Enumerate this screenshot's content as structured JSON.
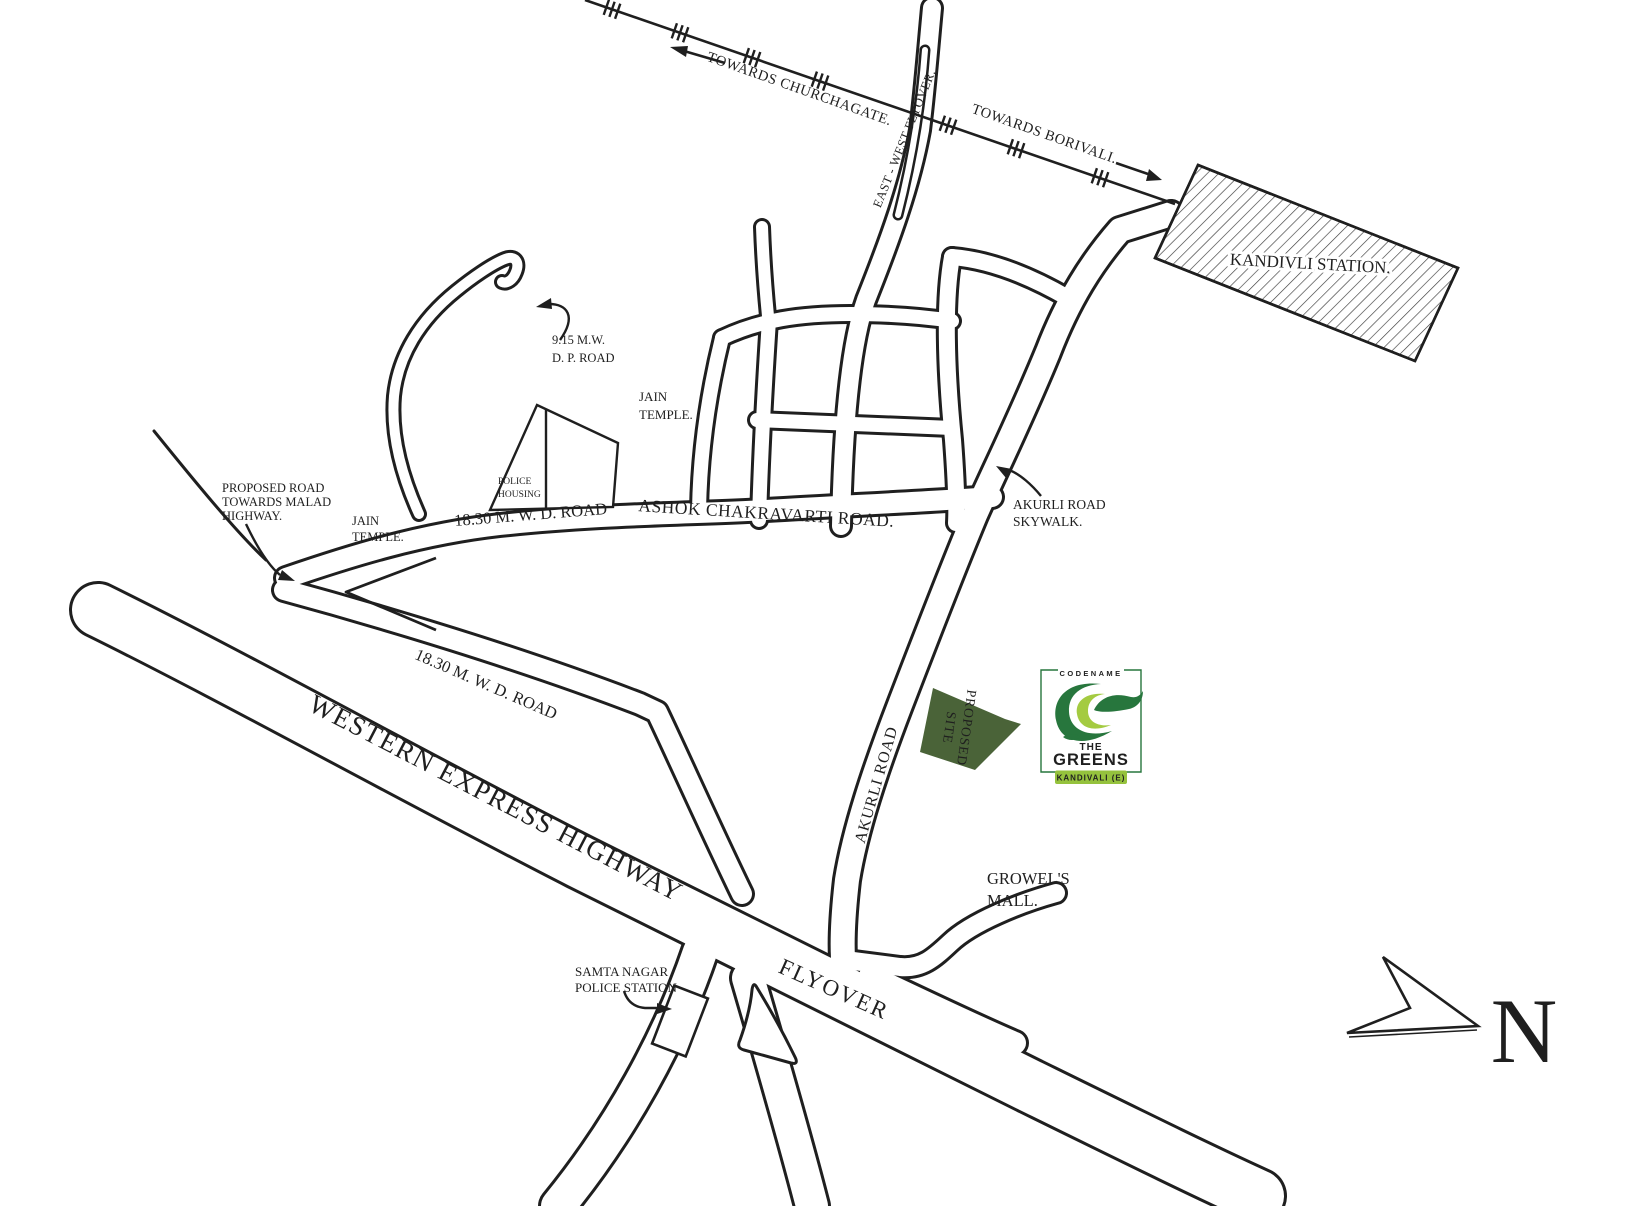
{
  "colors": {
    "ink": "#1f1f1f",
    "site_green": "#4a6338",
    "logo_dark_green": "#27763d",
    "logo_light_green": "#a4cb41",
    "logo_badge_green": "#95c23d"
  },
  "railway": {
    "towards_churchgate": "TOWARDS CHURCHAGATE.",
    "towards_borivali": "TOWARDS BORIVALI.",
    "flyover_label": "EAST - WEST FLYOVER."
  },
  "station": {
    "label": "KANDIVLI STATION."
  },
  "labels": {
    "dp_road": {
      "l1": "9.15 M.W.",
      "l2": "D. P. ROAD"
    },
    "jain_temple_east": {
      "l1": "JAIN",
      "l2": "TEMPLE."
    },
    "jain_temple_west": {
      "l1": "JAIN",
      "l2": "TEMPLE."
    },
    "police_housing": {
      "l1": "POLICE",
      "l2": "HOUSING"
    },
    "proposed_road": {
      "l1": "PROPOSED ROAD",
      "l2": "TOWARDS MALAD",
      "l3": "HIGHWAY."
    },
    "mwd_road_upper": "18.30 M. W. D. ROAD",
    "mwd_road_lower": "18.30 M. W. D. ROAD",
    "ashok_road": "ASHOK CHAKRAVARTI  ROAD.",
    "skywalk": {
      "l1": "AKURLI ROAD",
      "l2": "SKYWALK."
    },
    "akurli_road": "AKURLI ROAD",
    "growels_mall": {
      "l1": "GROWEL'S",
      "l2": "MALL."
    },
    "weh": "WESTERN EXPRESS HIGHWAY",
    "flyover": "FLYOVER",
    "samta_nagar": {
      "l1": "SAMTA NAGAR",
      "l2": "POLICE STATION"
    }
  },
  "site": {
    "l1": "PROPOSED",
    "l2": "SITE",
    "color": "#4a6338"
  },
  "logo": {
    "codename": "CODENAME",
    "the": "THE",
    "greens": "GREENS",
    "badge": "KANDIVALI (E)",
    "dark": "#27763d",
    "light": "#a4cb41",
    "badge_bg": "#95c23d"
  },
  "compass": {
    "north": "N"
  }
}
